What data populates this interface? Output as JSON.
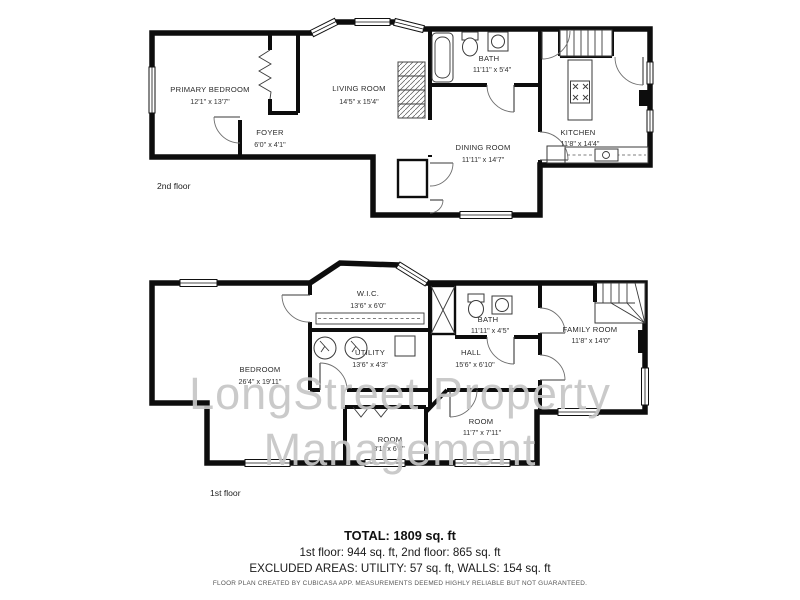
{
  "watermark": {
    "line1": "LongStreet Property",
    "line2": "Management"
  },
  "floor2": {
    "label": "2nd floor",
    "rooms": {
      "primary_bedroom": {
        "name": "PRIMARY BEDROOM",
        "dims": "12'1\" x 13'7\""
      },
      "living_room": {
        "name": "LIVING ROOM",
        "dims": "14'5\" x 15'4\""
      },
      "foyer": {
        "name": "FOYER",
        "dims": "6'0\" x 4'1\""
      },
      "bath": {
        "name": "BATH",
        "dims": "11'11\" x 5'4\""
      },
      "dining_room": {
        "name": "DINING ROOM",
        "dims": "11'11\" x 14'7\""
      },
      "kitchen": {
        "name": "KITCHEN",
        "dims": "11'8\" x 14'4\""
      }
    }
  },
  "floor1": {
    "label": "1st floor",
    "rooms": {
      "wic": {
        "name": "W.I.C.",
        "dims": "13'6\" x 6'0\""
      },
      "utility": {
        "name": "UTILITY",
        "dims": "13'6\" x 4'3\""
      },
      "bedroom": {
        "name": "BEDROOM",
        "dims": "26'4\" x 19'11\""
      },
      "bath": {
        "name": "BATH",
        "dims": "11'11\" x 4'5\""
      },
      "hall": {
        "name": "HALL",
        "dims": "15'6\" x 6'10\""
      },
      "family_room": {
        "name": "FAMILY ROOM",
        "dims": "11'8\" x 14'0\""
      },
      "room_small": {
        "name": "ROOM",
        "dims": "8'1\" x 6'4\""
      },
      "room_right": {
        "name": "ROOM",
        "dims": "11'7\" x 7'11\""
      }
    }
  },
  "summary": {
    "total": "TOTAL: 1809 sq. ft",
    "floors": "1st floor: 944 sq. ft, 2nd floor: 865 sq. ft",
    "excluded": "EXCLUDED AREAS: UTILITY: 57 sq. ft, WALLS: 154 sq. ft",
    "disclaimer": "FLOOR PLAN CREATED BY CUBICASA APP. MEASUREMENTS DEEMED HIGHLY RELIABLE BUT NOT GUARANTEED."
  }
}
